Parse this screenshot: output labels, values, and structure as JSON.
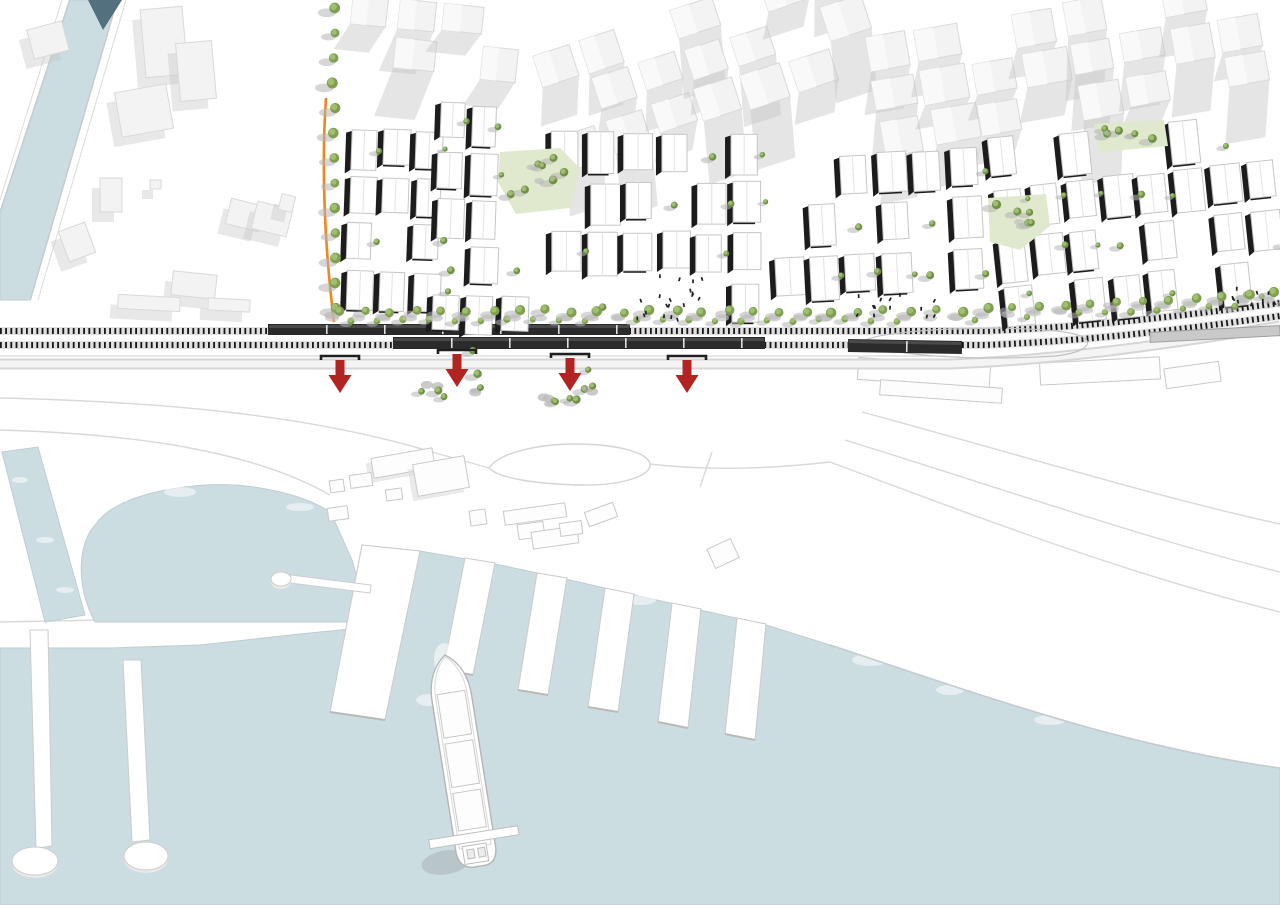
{
  "title": "Waterfront railway masterplan site plan with harbor, piers, cargo ship and four underpass arrows",
  "canvas": {
    "width": 1280,
    "height": 905
  },
  "palette": {
    "background": "#ffffff",
    "water": "#ccdde2",
    "water_edge": "#bfcdd2",
    "bridge": "#53707e",
    "context_fill": "#f3f3f3",
    "context_stroke": "#d9d9d9",
    "context_shadow": "#c5c5c5",
    "plan_roof": "#ffffff",
    "plan_stroke": "#c6c6c6",
    "plan_dark": "#1c1c1c",
    "tree_canopy": "#7fa04f",
    "tree_canopy_light": "#a3bf74",
    "tree_shadow": "#b5b5b5",
    "park_fill": "#e0e9cd",
    "orange": "#f0861d",
    "arrow_red": "#b22421",
    "rail_dark": "#161616",
    "train_dark": "#2b2b2b",
    "train_light": "#c9c9c9",
    "road_fill": "#d6d6d6",
    "faint_line": "#d9d9d9",
    "quay_stroke": "#cccccc",
    "people": "#1d1d1d",
    "pier_fill": "#ffffff",
    "ship_stroke": "#bdbdbd",
    "foam": "#ffffff"
  },
  "water": {
    "canal_upper": [
      [
        70,
        0
      ],
      [
        117,
        0
      ],
      [
        30,
        300
      ],
      [
        0,
        300
      ],
      [
        0,
        213
      ]
    ],
    "bridge_triangle": [
      [
        88,
        0
      ],
      [
        122,
        0
      ],
      [
        103,
        30
      ]
    ],
    "canal_lower": [
      [
        2,
        452
      ],
      [
        38,
        447
      ],
      [
        85,
        615
      ],
      [
        45,
        622
      ]
    ],
    "basin_path": "M 95,622 C 75,585 78,542 96,524 C 110,503 150,489 205,485 C 255,482 308,496 331,513 L 352,560 L 368,618 L 368,622 Z",
    "main_path": "M 0,648 L 110,648 L 200,645 L 300,634 L 360,628 L 368,620 L 372,560 L 362,545 L 420,551 L 500,565 L 570,580 L 635,595 L 700,610 L 763,624 L 830,645 C 900,668 990,700 1090,728 C 1160,747 1220,760 1280,768 L 1280,905 L 0,905 Z",
    "foam": [
      [
        180,
        492,
        16,
        5
      ],
      [
        300,
        507,
        14,
        4
      ],
      [
        90,
        470,
        10,
        4
      ],
      [
        480,
        575,
        14,
        5
      ],
      [
        640,
        600,
        16,
        5
      ],
      [
        870,
        660,
        18,
        6
      ],
      [
        1050,
        720,
        16,
        5
      ],
      [
        460,
        640,
        12,
        5
      ],
      [
        430,
        700,
        14,
        6
      ],
      [
        20,
        480,
        8,
        3
      ],
      [
        45,
        540,
        9,
        3
      ],
      [
        65,
        590,
        9,
        3
      ],
      [
        250,
        630,
        18,
        5
      ],
      [
        950,
        690,
        14,
        5
      ]
    ]
  },
  "harbor": {
    "wide_pier": [
      [
        362,
        545
      ],
      [
        420,
        551
      ],
      [
        385,
        720
      ],
      [
        330,
        712
      ]
    ],
    "fingers": [
      [
        [
          465,
          558
        ],
        [
          495,
          563
        ],
        [
          473,
          675
        ],
        [
          443,
          670
        ]
      ],
      [
        [
          537,
          573
        ],
        [
          567,
          578
        ],
        [
          548,
          695
        ],
        [
          518,
          690
        ]
      ],
      [
        [
          605,
          588
        ],
        [
          634,
          594
        ],
        [
          618,
          712
        ],
        [
          588,
          707
        ]
      ],
      [
        [
          672,
          603
        ],
        [
          701,
          609
        ],
        [
          688,
          728
        ],
        [
          658,
          722
        ]
      ],
      [
        [
          737,
          618
        ],
        [
          766,
          624
        ],
        [
          755,
          740
        ],
        [
          725,
          734
        ]
      ]
    ],
    "jetty1": [
      [
        30,
        630
      ],
      [
        48,
        630
      ],
      [
        52,
        846
      ],
      [
        36,
        848
      ]
    ],
    "jetty1_disc": [
      35,
      861,
      23,
      14
    ],
    "jetty2": [
      [
        123,
        660
      ],
      [
        141,
        660
      ],
      [
        150,
        840
      ],
      [
        132,
        842
      ]
    ],
    "jetty2_disc": [
      146,
      856,
      22,
      14
    ],
    "stub": [
      [
        283,
        574
      ],
      [
        371,
        585
      ],
      [
        370,
        593
      ],
      [
        282,
        582
      ]
    ],
    "stub_disc": [
      281,
      579,
      10,
      7
    ]
  },
  "quay": {
    "faint_roads": [
      "M 0,398 C 180,402 320,418 432,452",
      "M 0,430 C 140,434 255,452 330,495",
      "M 432,452 C 460,460 478,465 489,468",
      "M 650,464 C 700,470 760,470 830,462",
      "M 830,462 C 985,520 1130,575 1280,612",
      "M 845,440 C 1000,488 1150,540 1280,572",
      "M 862,412 C 1010,452 1160,498 1280,524",
      "M 700,487 L 712,452",
      "M 0,622 L 200,618 L 300,610 L 352,604"
    ],
    "loop_road": "M 489,468 C 500,452 540,444 575,444 C 615,444 648,452 650,464 C 652,476 620,486 580,485 C 535,484 498,478 489,468 Z",
    "balloon_loop": "M 864,341 C 885,327 1058,323 1083,337 C 1093,343 1087,352 1056,356 C 975,361 882,356 864,341 Z",
    "shore_edge": "M 830,645 C 900,668 990,700 1090,728 C 1160,747 1220,760 1280,768",
    "buildings": [
      [
        372,
        453,
        62,
        20,
        -10,
        1
      ],
      [
        415,
        460,
        52,
        32,
        -10,
        1
      ],
      [
        330,
        480,
        14,
        12,
        -8,
        0
      ],
      [
        350,
        474,
        22,
        13,
        -8,
        0
      ],
      [
        386,
        489,
        16,
        11,
        -8,
        0
      ],
      [
        328,
        507,
        20,
        13,
        -8,
        0
      ],
      [
        470,
        510,
        16,
        15,
        -8,
        0
      ],
      [
        504,
        507,
        62,
        14,
        -8,
        0
      ],
      [
        518,
        523,
        26,
        15,
        -8,
        0
      ],
      [
        532,
        529,
        46,
        17,
        -8,
        0
      ],
      [
        560,
        522,
        22,
        13,
        -8,
        0
      ],
      [
        586,
        507,
        30,
        15,
        -20,
        0
      ],
      [
        710,
        543,
        26,
        21,
        -25,
        0
      ],
      [
        858,
        362,
        132,
        22,
        4,
        0
      ],
      [
        880,
        384,
        122,
        15,
        4,
        0
      ],
      [
        1040,
        360,
        120,
        22,
        -3,
        0
      ],
      [
        1165,
        365,
        55,
        20,
        -8,
        0
      ]
    ]
  },
  "railway": {
    "ladders": [
      "M 0,331 L 985,331 C 1090,327 1180,316 1280,303",
      "M 0,345 L 985,345 C 1090,341 1185,329 1280,316"
    ],
    "platform_line": "M 0,356 L 945,356",
    "trains": [
      {
        "x": 268,
        "y": 324,
        "w": 362,
        "h": 11,
        "rot": 0,
        "dark": true
      },
      {
        "x": 393,
        "y": 337,
        "w": 372,
        "h": 12,
        "rot": 0,
        "dark": true
      },
      {
        "x": 848,
        "y": 340,
        "w": 114,
        "h": 13,
        "rot": 1,
        "dark": true
      },
      {
        "x": 1150,
        "y": 329,
        "w": 130,
        "h": 10,
        "rot": -3,
        "dark": false
      }
    ],
    "road_path": "M 0,364 L 950,364 C 1060,360 1170,344 1280,326"
  },
  "arrows": {
    "items": [
      [
        340,
        358
      ],
      [
        457,
        352
      ],
      [
        570,
        356
      ],
      [
        687,
        358
      ]
    ],
    "portal_halfw": 19
  },
  "arrow_tree_clusters": [
    {
      "x0": 420,
      "y0": 350,
      "x1": 500,
      "y1": 402,
      "n": 6,
      "seed": 5
    },
    {
      "x0": 532,
      "y0": 352,
      "x1": 615,
      "y1": 405,
      "n": 7,
      "seed": 9
    }
  ],
  "boulevard": {
    "orange_path": "M 326,98 C 321,170 325,250 334,322",
    "tree_x": 334,
    "tree_y0": 8,
    "tree_y1": 312,
    "step": 25
  },
  "promenade": {
    "x0": 338,
    "x1": 1274,
    "step": 26,
    "y": 311,
    "bend_x": 950,
    "slope": -0.055
  },
  "parks": [
    {
      "pts": [
        [
          500,
          152
        ],
        [
          560,
          148
        ],
        [
          580,
          168
        ],
        [
          570,
          208
        ],
        [
          516,
          214
        ],
        [
          498,
          182
        ]
      ],
      "trees": 7,
      "seed": 3
    },
    {
      "pts": [
        [
          988,
          198
        ],
        [
          1046,
          194
        ],
        [
          1050,
          226
        ],
        [
          1020,
          250
        ],
        [
          990,
          242
        ]
      ],
      "trees": 5,
      "seed": 7
    },
    {
      "pts": [
        [
          1094,
          124
        ],
        [
          1164,
          120
        ],
        [
          1168,
          146
        ],
        [
          1100,
          152
        ]
      ],
      "trees": 5,
      "seed": 13
    }
  ],
  "districts": [
    {
      "x0": 344,
      "y0": 126,
      "x1": 432,
      "y1": 316,
      "rot": 2,
      "cw": 33,
      "ch": 47,
      "skip": 0.22,
      "seed": 11,
      "holes": []
    },
    {
      "x0": 432,
      "y0": 100,
      "x1": 540,
      "y1": 316,
      "rot": 2,
      "cw": 34,
      "ch": 48,
      "skip": 0.24,
      "seed": 17,
      "holes": [
        [
          490,
          145,
          98,
          74
        ]
      ]
    },
    {
      "x0": 548,
      "y0": 128,
      "x1": 762,
      "y1": 316,
      "rot": 0,
      "cw": 36,
      "ch": 50,
      "skip": 0.25,
      "seed": 23,
      "holes": [
        [
          645,
          255,
          70,
          61
        ]
      ]
    },
    {
      "x0": 768,
      "y0": 148,
      "x1": 986,
      "y1": 316,
      "rot": -3,
      "cw": 36,
      "ch": 50,
      "skip": 0.25,
      "seed": 37,
      "holes": [
        [
          978,
          190,
          74,
          62
        ]
      ]
    },
    {
      "x0": 992,
      "y0": 120,
      "x1": 1278,
      "y1": 300,
      "rot": -6,
      "cw": 36,
      "ch": 50,
      "skip": 0.28,
      "seed": 51,
      "holes": [
        [
          1088,
          115,
          84,
          42
        ]
      ]
    }
  ],
  "context_districts": [
    {
      "x0": 345,
      "y0": 0,
      "x1": 540,
      "y1": 94,
      "rot": 6,
      "cw": 46,
      "ch": 40,
      "skip": 0.3,
      "seed": 71
    },
    {
      "x0": 540,
      "y0": 0,
      "x1": 870,
      "y1": 124,
      "rot": -18,
      "cw": 48,
      "ch": 42,
      "skip": 0.28,
      "seed": 83
    },
    {
      "x0": 870,
      "y0": 0,
      "x1": 1278,
      "y1": 126,
      "rot": -10,
      "cw": 50,
      "ch": 42,
      "skip": 0.3,
      "seed": 97
    }
  ],
  "context_buildings": [
    [
      30,
      25,
      36,
      30,
      -15
    ],
    [
      143,
      8,
      42,
      68,
      -5
    ],
    [
      178,
      42,
      36,
      58,
      -5
    ],
    [
      118,
      88,
      52,
      45,
      -10
    ],
    [
      100,
      178,
      22,
      34,
      0
    ],
    [
      63,
      226,
      28,
      32,
      -20
    ],
    [
      228,
      202,
      34,
      26,
      14
    ],
    [
      254,
      205,
      36,
      28,
      14
    ],
    [
      280,
      195,
      14,
      16,
      14
    ],
    [
      150,
      180,
      11,
      9,
      0
    ],
    [
      172,
      273,
      44,
      24,
      6
    ],
    [
      118,
      296,
      62,
      14,
      3
    ],
    [
      208,
      299,
      42,
      12,
      3
    ]
  ],
  "canal_quays": [
    {
      "d": "M 70,0 L 0,213",
      "w": 2
    },
    {
      "d": "M 117,0 L 30,300",
      "w": 2
    },
    {
      "d": "M 62,0 L 0,200",
      "w": 1
    },
    {
      "d": "M 126,0 L 38,300",
      "w": 1
    }
  ],
  "ship": {
    "x": 445,
    "y": 655,
    "rot": -9,
    "hull": "M 0,0 C -14,10 -20,26 -20,44 L -20,196 Q -20,212 -6,214 L 8,214 Q 20,212 20,196 L 20,44 C 20,26 14,10 0,0 Z",
    "hatches": [
      [
        -14,
        38,
        28,
        44
      ],
      [
        -14,
        88,
        28,
        44
      ],
      [
        -14,
        138,
        28,
        38
      ]
    ],
    "beam": [
      -45,
      180,
      90,
      9
    ],
    "bridge": [
      [
        -13,
        192,
        24,
        18
      ],
      [
        -9,
        196,
        7,
        9
      ],
      [
        2,
        196,
        7,
        9
      ]
    ],
    "shadow": [
      -32,
      205,
      24,
      12
    ]
  },
  "people_clusters": [
    {
      "x0": 636,
      "y0": 296,
      "x1": 700,
      "y1": 318,
      "n": 12,
      "seed": 2
    },
    {
      "x0": 655,
      "y0": 268,
      "x1": 705,
      "y1": 295,
      "n": 8,
      "seed": 4
    },
    {
      "x0": 856,
      "y0": 293,
      "x1": 938,
      "y1": 315,
      "n": 13,
      "seed": 6
    },
    {
      "x0": 1230,
      "y0": 286,
      "x1": 1276,
      "y1": 308,
      "n": 9,
      "seed": 8
    }
  ]
}
